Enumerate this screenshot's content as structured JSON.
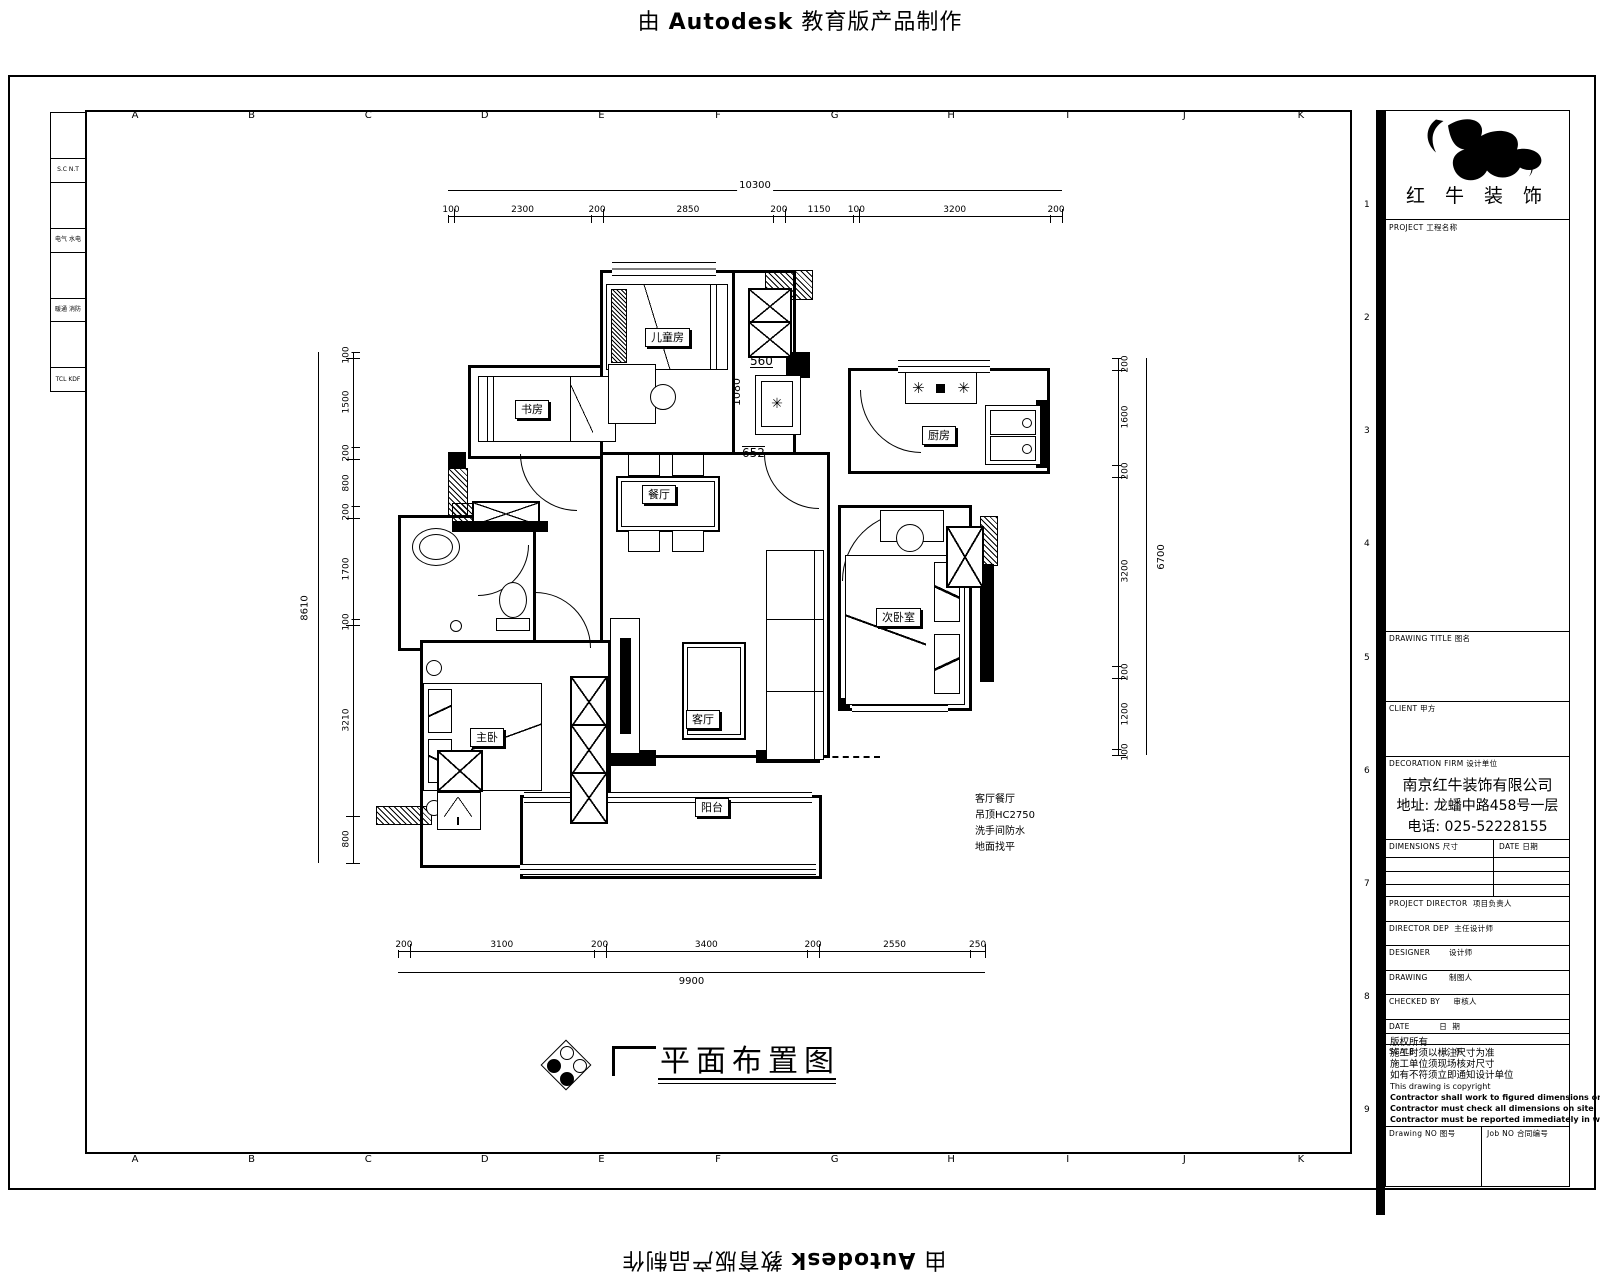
{
  "watermark": {
    "prefix": "由 ",
    "brand": "Autodesk",
    "suffix": " 教育版产品制作"
  },
  "grid": {
    "letters": [
      "A",
      "B",
      "C",
      "D",
      "E",
      "F",
      "G",
      "H",
      "I",
      "J",
      "K"
    ],
    "numbers": [
      "1",
      "2",
      "3",
      "4",
      "5",
      "6",
      "7",
      "8",
      "9"
    ]
  },
  "side_table": {
    "rows": [
      "S.C N.T",
      "电气 水电",
      "暖通 消防",
      "TCL KDF"
    ]
  },
  "title_block": {
    "brand": "红 牛 装 饰",
    "project_label": "PROJECT 工程名称",
    "drawing_title_label": "DRAWING TITLE 图名",
    "client_label": "CLIENT 甲方",
    "firm_label": "DECORATION FIRM 设计单位",
    "company": {
      "name": "南京红牛装饰有限公司",
      "address": "地址: 龙蟠中路458号一层",
      "phone": "电话: 025-52228155"
    },
    "dimensions_label": "DIMENSIONS 尺寸",
    "date_label": "DATE 日期",
    "rows": [
      "PROJECT DIRECTOR  项目负责人",
      "DIRECTOR DEP  主任设计师",
      "DESIGNER       设计师",
      "DRAWING        制图人",
      "CHECKED BY     审核人",
      "DATE           日  期",
      "SCALE          比  例"
    ],
    "notes_cn": [
      "版权所有",
      "施工时须以标注尺寸为准",
      "施工单位须现场核对尺寸",
      "如有不符须立即通知设计单位"
    ],
    "notes_en": [
      "This drawing is copyright",
      "Contractor shall work to figured dimensions only",
      "Contractor must check all dimensions on site",
      "Contractor must be reported immediately in writing"
    ],
    "drawing_no_label": "Drawing NO 图号",
    "job_no_label": "Job NO 合同编号"
  },
  "plan": {
    "rooms": {
      "children": "儿童房",
      "study": "书房",
      "kitchen": "厨房",
      "dining": "餐厅",
      "living": "客厅",
      "bedroom2": "次卧室",
      "master": "主卧",
      "balcony": "阳台"
    },
    "inline_dims": {
      "d560": "560",
      "d1080": "1080",
      "d652": "652"
    },
    "note_lines": [
      "客厅餐厅",
      "吊顶HC2750",
      "洗手间防水",
      "地面找平"
    ]
  },
  "dims": {
    "top": {
      "overall": "10300",
      "segments": [
        "100",
        "2300",
        "200",
        "2850",
        "200",
        "1150",
        "100",
        "3200",
        "200"
      ]
    },
    "bottom": {
      "overall": "9900",
      "segments": [
        "200",
        "3100",
        "200",
        "3400",
        "200",
        "2550",
        "250"
      ]
    },
    "left": {
      "overall": "8610",
      "segments": [
        "100",
        "1500",
        "200",
        "800",
        "200",
        "1700",
        "100",
        "3210",
        "800"
      ]
    },
    "right": {
      "overall": "6700",
      "segments": [
        "200",
        "1600",
        "200",
        "3200",
        "200",
        "1200",
        "100"
      ]
    }
  },
  "footer": {
    "title": "平面布置图"
  }
}
